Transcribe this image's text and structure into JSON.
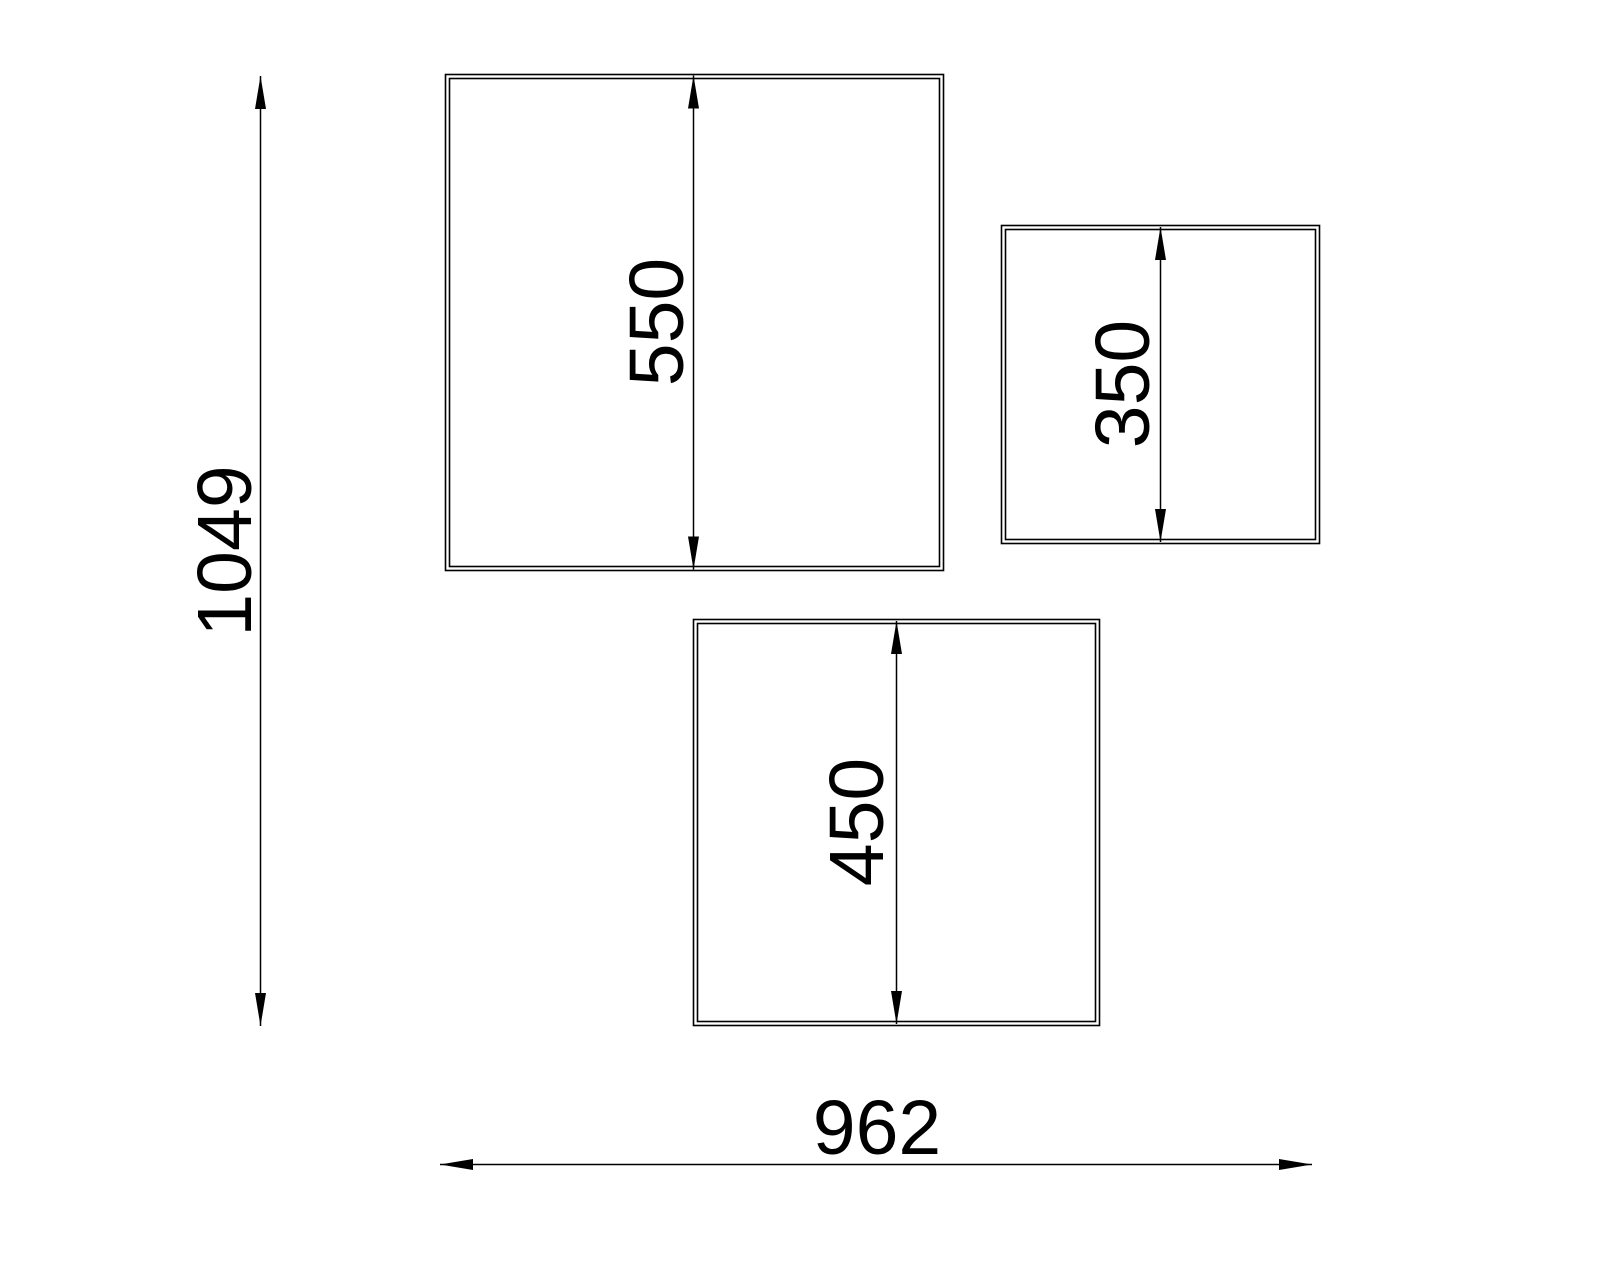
{
  "drawing": {
    "type": "technical-dimension-drawing",
    "colors": {
      "background": "#ffffff",
      "line": "#000000",
      "text": "#000000"
    },
    "dims": {
      "overall_height": "1049",
      "overall_width": "962",
      "panel_large_height": "550",
      "panel_small_height": "350",
      "panel_medium_height": "450"
    },
    "panels": [
      {
        "id": "large",
        "height_label": "550"
      },
      {
        "id": "small",
        "height_label": "350"
      },
      {
        "id": "medium",
        "height_label": "450"
      }
    ]
  }
}
